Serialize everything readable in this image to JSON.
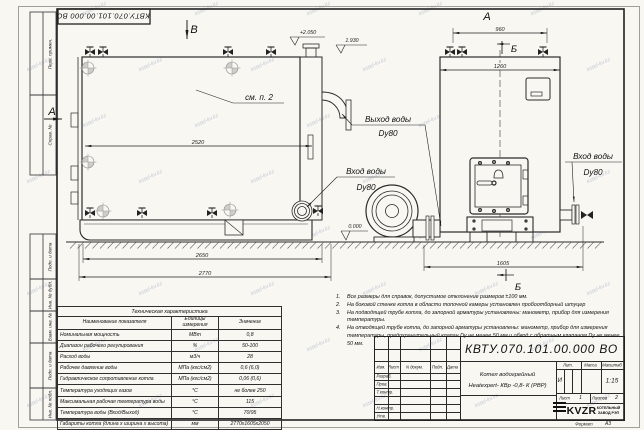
{
  "sheet": {
    "stamp_top": "КВТУ.070.101.00.000 ВО",
    "watermark": "kotel-kv.kz",
    "margin_labels": [
      "Перв. примен.",
      "Справ. №",
      "Подп. и дата",
      "Инв. № дубл.",
      "Взам. инв. №",
      "Подп. и дата",
      "Инв. № подл."
    ],
    "format_label": "Формат",
    "format_value": "А3"
  },
  "views": {
    "view_b_label": "В",
    "view_a_side_label": "А",
    "view_a_top_label": "А",
    "section_b_top": "Б",
    "section_b_bottom": "Б",
    "see_item": "см. п. 2",
    "elevations": {
      "top": "+2.050",
      "mid": "1.930",
      "zero": "0.000"
    },
    "dimensions": {
      "len_body": "2520",
      "len_base": "2650",
      "len_total": "2770",
      "width_top": "960",
      "width_body": "1260",
      "width_total": "1605"
    },
    "port_labels": {
      "outlet": "Выход воды",
      "outlet_dn": "Dy80",
      "inlet_left": "Вход воды",
      "inlet_left_dn": "Dy80",
      "inlet_right": "Вход воды",
      "inlet_right_dn": "Dy80"
    }
  },
  "notes": {
    "items": [
      {
        "n": "1.",
        "t": "Все размеры для справок, допустимое отклонение размеров ±100 мм."
      },
      {
        "n": "2.",
        "t": "На боковой стенке котла в области топочной камеры установлен пробоотборный штуцер"
      },
      {
        "n": "3.",
        "t": "На подводящей трубе котла, до запорной арматуры установлены: манометр, прибор для измерения температуры."
      },
      {
        "n": "4.",
        "t": "На отводящей трубе котла, до запорной арматуры установлены: манометр, прибор для измерения температуры, предохранительный клапан Dу не менее 50 мм и обвод с обратным клапаном Dу не менее 50 мм."
      }
    ]
  },
  "tech_table": {
    "title": "Техническая характеристика",
    "headers": [
      "Наименование показателя",
      "Единицы измерения",
      "Значение"
    ],
    "rows": [
      [
        "Номинальная мощность",
        "МВт",
        "0,8"
      ],
      [
        "Диапазон рабочего регулирования",
        "%",
        "50-100"
      ],
      [
        "Расход воды",
        "м3/ч",
        "28"
      ],
      [
        "Рабочее давление воды",
        "МПа (кгс/см2)",
        "0,6 (6,0)"
      ],
      [
        "Гидравлическое сопротивление котла",
        "МПа (кгс/см2)",
        "0,06 (0,6)"
      ],
      [
        "Температура уходящих газов",
        "°С",
        "не более 250"
      ],
      [
        "Максимальная рабочая температура воды",
        "°С",
        "115"
      ],
      [
        "Температура воды (Вход/Выход)",
        "°С",
        "70/95"
      ],
      [
        "Габариты котла (длина х ширина х высота)",
        "мм",
        "2770х1605х2050"
      ]
    ]
  },
  "title_block": {
    "designation": "КВТУ.070.101.00.000  ВО",
    "header_cols": [
      "Изм.",
      "Лист",
      "N докум.",
      "Подп.",
      "Дата"
    ],
    "rows": [
      "Разраб.",
      "Пров.",
      "Т.контр.",
      "",
      "Н.контр.",
      "Утв."
    ],
    "name_line1": "Котел водогрейный",
    "name_line2": "Heatexpert- КВр -0,8- К (РВР)",
    "lit_label": "Лит.",
    "lit_value": "И",
    "mass_label": "Масса",
    "scale_label": "Масштаб",
    "scale_value": "1:15",
    "sheet_label": "Лист",
    "sheet_value": "1",
    "sheets_label": "Листов",
    "sheets_value": "2",
    "logo_text": "KVZR",
    "logo_sub1": "КОТЕЛЬНЫЙ",
    "logo_sub2": "ЗАВОД РЭП"
  }
}
